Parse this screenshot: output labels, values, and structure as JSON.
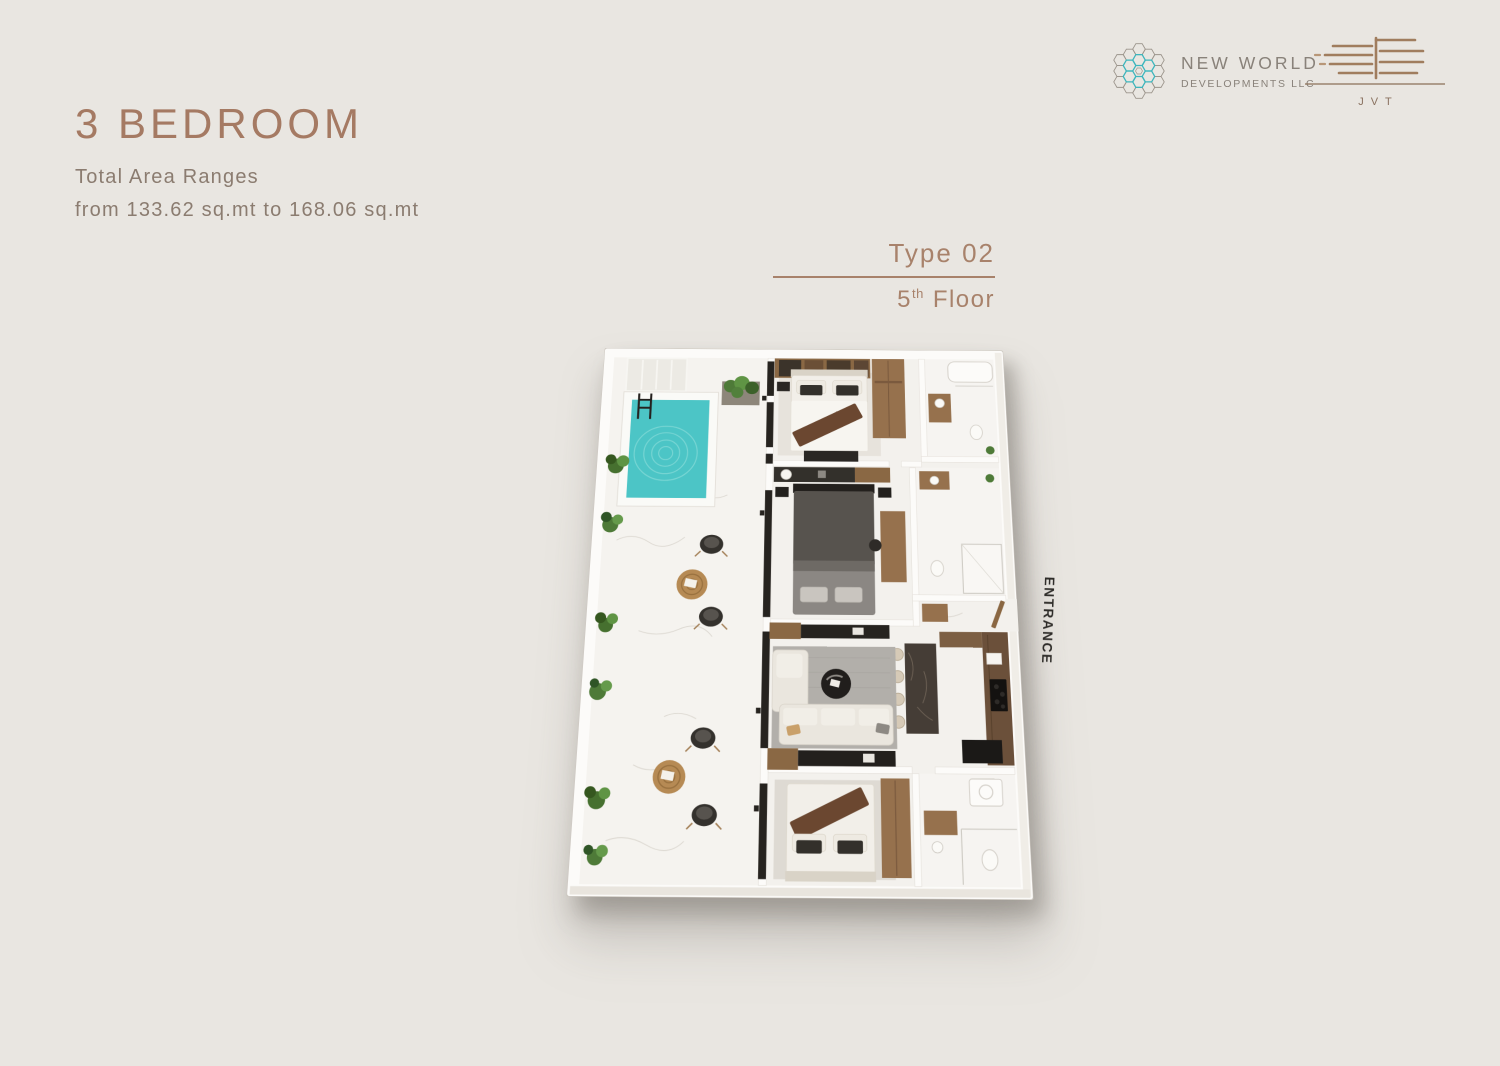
{
  "page": {
    "background_color": "#e9e6e1"
  },
  "header": {
    "title": "3 BEDROOM",
    "subtitle_line1": "Total Area Ranges",
    "subtitle_line2": "from 133.62 sq.mt to 168.06 sq.mt",
    "accent_color": "#a57a63",
    "subtitle_color": "#8b7c70"
  },
  "brand": {
    "new_world": {
      "icon": "hexagon-flower-icon",
      "line1": "NEW WORLD",
      "line2": "DEVELOPMENTS LLC",
      "icon_teal": "#3cb6bd",
      "icon_gray": "#9b948b",
      "text_color": "#89827a"
    },
    "jvt": {
      "icon": "jvt-building-icon",
      "label": "JVT",
      "color": "#9c7a5c"
    }
  },
  "unit": {
    "type_label": "Type 02",
    "floor_number": "5",
    "floor_ordinal": "th",
    "floor_word": "Floor",
    "accent_color": "#a8826b"
  },
  "floor_plan": {
    "entrance_label": "ENTRANCE",
    "view": "3d-top-down",
    "colors": {
      "wall": "#fcfbf9",
      "floor_marble": "#f3f1ed",
      "pool_water": "#4cc5c6",
      "wood": "#96714d",
      "dark_furniture": "#2a2724",
      "rug": "#b2afaa",
      "plants": "#4e7a38"
    },
    "features": [
      "terrace",
      "pool",
      "bedroom-1",
      "bedroom-2",
      "bedroom-3",
      "bathroom-1",
      "bathroom-2",
      "bathroom-3",
      "living-room",
      "kitchen",
      "entrance-foyer"
    ]
  }
}
